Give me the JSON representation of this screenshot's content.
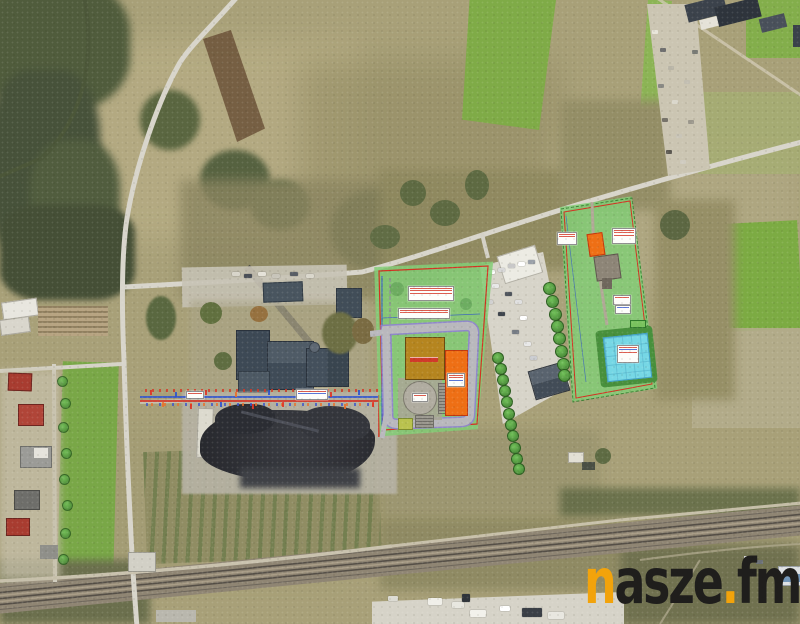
{
  "watermark": {
    "n": "n",
    "asze": "asze",
    "dot": ".",
    "fm": "fm"
  },
  "palette": {
    "base": "#a8a078",
    "accent": "#f2a30b",
    "wm-dark": "#1f1e1c",
    "plan-green": "#82ca76",
    "plan-green-dark": "#3f8f3b",
    "pond": "#76d7e5",
    "pond-edge": "#48903c",
    "orange-bldg": "#ee6f15",
    "brown-bldg": "#b5851f",
    "red-line": "#d23323",
    "blue-line": "#2f54cc",
    "violet-line": "#8f84cf",
    "road": "#d8d5cb",
    "rail": "#8f8573",
    "slate-bldg": "#46525e",
    "coal": "#2f3136",
    "forest": "#4c5739",
    "field-green": "#7fab47"
  },
  "overlays": {
    "left_plan": {
      "elements": [
        "boundary-red",
        "ring-road",
        "main-hall-building",
        "tall-building",
        "tank-circle",
        "utility-building",
        "label-boxes"
      ],
      "trees": [
        [
          492,
          352
        ],
        [
          495,
          363
        ],
        [
          497,
          374
        ],
        [
          499,
          385
        ],
        [
          501,
          396
        ],
        [
          503,
          408
        ],
        [
          505,
          419
        ],
        [
          507,
          430
        ],
        [
          509,
          442
        ],
        [
          511,
          453
        ],
        [
          513,
          463
        ]
      ]
    },
    "right_plan": {
      "elements": [
        "boundary-red",
        "access-track",
        "small-orange-building",
        "gravel-pad",
        "retention-pond",
        "label-boxes"
      ]
    },
    "corridor_marks": [
      [
        150,
        390,
        "#e03323"
      ],
      [
        162,
        402,
        "#e8702a"
      ],
      [
        175,
        392,
        "#2f54cc"
      ],
      [
        190,
        404,
        "#e03323"
      ],
      [
        205,
        390,
        "#e03323"
      ],
      [
        220,
        402,
        "#2f54cc"
      ],
      [
        235,
        392,
        "#e8702a"
      ],
      [
        252,
        404,
        "#e03323"
      ],
      [
        268,
        390,
        "#2f54cc"
      ],
      [
        282,
        402,
        "#e03323"
      ],
      [
        330,
        392,
        "#e03323"
      ],
      [
        344,
        404,
        "#e8702a"
      ],
      [
        358,
        390,
        "#2f54cc"
      ],
      [
        372,
        402,
        "#e03323"
      ]
    ]
  },
  "features": {
    "parking_vehicles": [
      [
        488,
        270,
        "#ffffff"
      ],
      [
        498,
        268,
        "#d8d8d8"
      ],
      [
        508,
        264,
        "#c8c8c8"
      ],
      [
        518,
        262,
        "#ffffff"
      ],
      [
        528,
        260,
        "#9aa0a8"
      ],
      [
        492,
        284,
        "#e8e8e8"
      ],
      [
        505,
        292,
        "#50565e"
      ],
      [
        515,
        300,
        "#e0e0e0"
      ],
      [
        520,
        316,
        "#ffffff"
      ],
      [
        512,
        330,
        "#757b83"
      ],
      [
        524,
        342,
        "#e8e8e8"
      ],
      [
        530,
        356,
        "#caccd0"
      ],
      [
        498,
        312,
        "#3f454d"
      ],
      [
        486,
        300,
        "#d0d0d0"
      ]
    ],
    "parking_trees": [
      [
        543,
        282
      ],
      [
        546,
        295
      ],
      [
        549,
        308
      ],
      [
        551,
        320
      ],
      [
        553,
        332
      ],
      [
        555,
        345
      ],
      [
        557,
        358
      ],
      [
        558,
        369
      ]
    ],
    "plant_vehicles": [
      [
        232,
        272,
        "#d8d5ca"
      ],
      [
        244,
        274,
        "#4a4f57"
      ],
      [
        258,
        272,
        "#e5e2d8"
      ],
      [
        272,
        274,
        "#c8c5ba"
      ],
      [
        290,
        272,
        "#585d65"
      ],
      [
        306,
        274,
        "#dad7cc"
      ]
    ],
    "depot_clutter": [
      [
        652,
        30,
        "#e8e5da"
      ],
      [
        660,
        48,
        "#6f6f6f"
      ],
      [
        668,
        66,
        "#b8b4a6"
      ],
      [
        658,
        84,
        "#8a8a85"
      ],
      [
        672,
        100,
        "#dad7cb"
      ],
      [
        662,
        118,
        "#77736a"
      ],
      [
        676,
        134,
        "#c9c5b8"
      ],
      [
        666,
        150,
        "#5d5a52"
      ],
      [
        680,
        160,
        "#cfcbbf"
      ],
      [
        688,
        120,
        "#9b978c"
      ],
      [
        684,
        80,
        "#c2beb1"
      ],
      [
        692,
        50,
        "#787a74"
      ]
    ],
    "yard_trucks": [
      [
        428,
        598,
        14,
        7,
        "#f0efe9"
      ],
      [
        452,
        602,
        12,
        6,
        "#e8e7e0"
      ],
      [
        470,
        610,
        16,
        7,
        "#f2f1eb"
      ],
      [
        500,
        606,
        10,
        5,
        "#ffffff"
      ],
      [
        522,
        608,
        20,
        9,
        "#3a3f46"
      ],
      [
        548,
        612,
        16,
        7,
        "#e8e7e0"
      ],
      [
        388,
        596,
        10,
        5,
        "#dcdbd3"
      ],
      [
        462,
        594,
        8,
        8,
        "#2f343a"
      ]
    ],
    "street_hedge": [
      [
        57,
        376
      ],
      [
        60,
        398
      ],
      [
        58,
        422
      ],
      [
        61,
        448
      ],
      [
        59,
        474
      ],
      [
        62,
        500
      ],
      [
        60,
        528
      ],
      [
        58,
        554
      ]
    ]
  }
}
